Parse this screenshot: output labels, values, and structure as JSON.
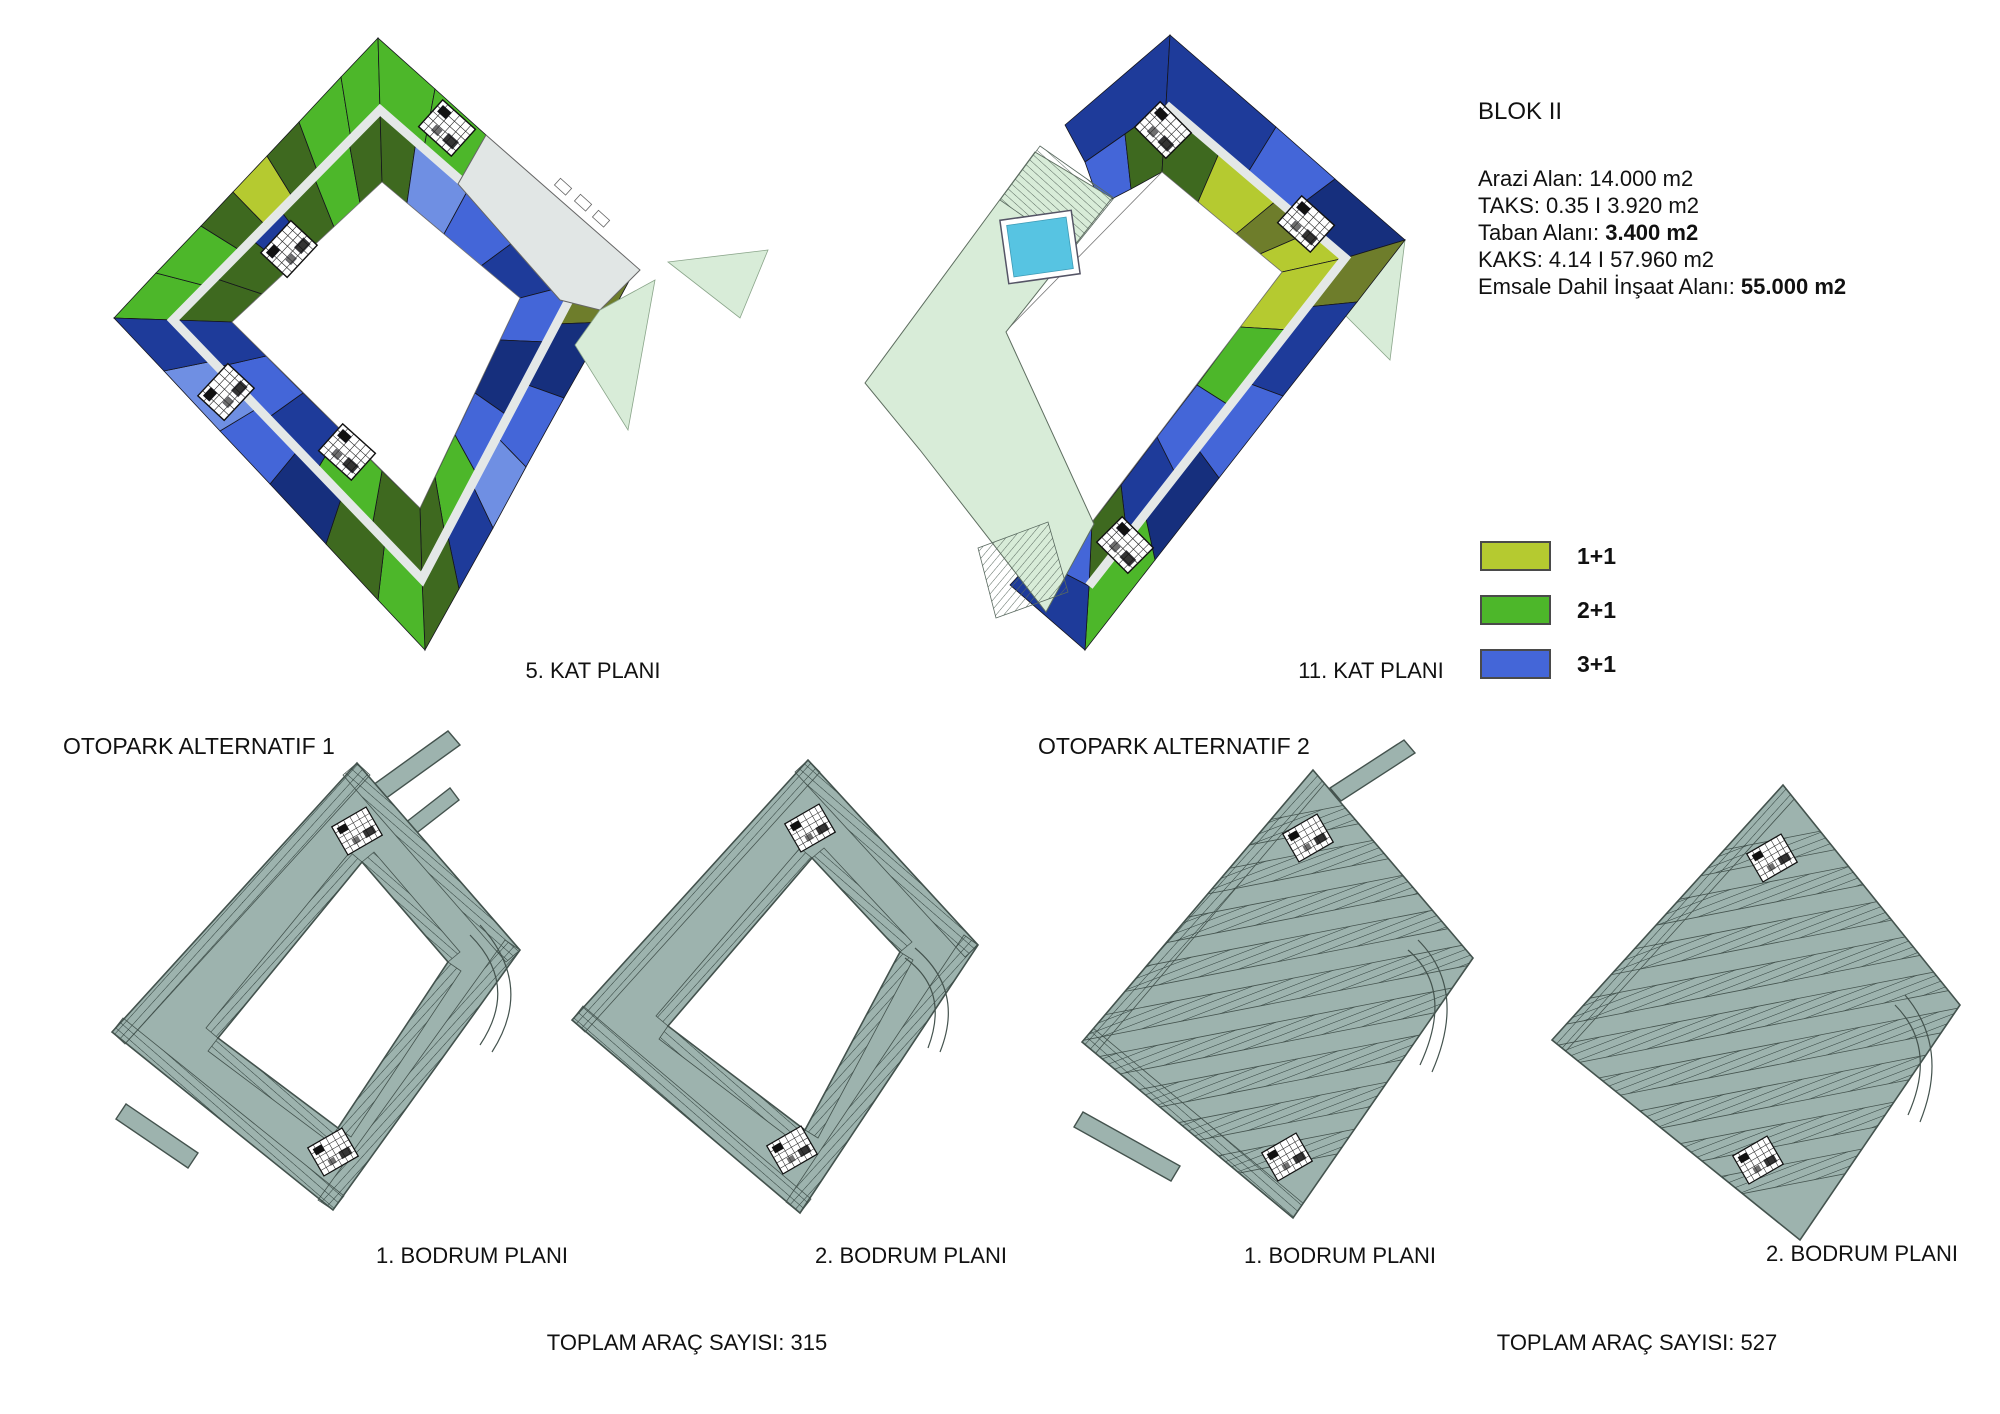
{
  "palette": {
    "green": "#4db72a",
    "darkGreen": "#3e691f",
    "yellowGreen": "#b5ca30",
    "khaki": "#6e7d2b",
    "blue": "#4466d8",
    "lightBlue": "#6f8fe3",
    "navy": "#1e3b9a",
    "navyDark": "#162f7d",
    "corridor": "#e4e8e7",
    "terraceGray": "#e1e6e5",
    "paleMint": "#d8ecd8",
    "pool": "#57c4e2",
    "parkSage": "#9db3ae",
    "parkLine": "#44534e",
    "stall": "#2e3e3a",
    "courtyard": "#ffffff"
  },
  "block_info": {
    "title": "BLOK II",
    "lines": [
      {
        "prefix": "Arazi Alan: 14.000 m2",
        "bold": ""
      },
      {
        "prefix": "TAKS: 0.35 I 3.920 m2",
        "bold": ""
      },
      {
        "prefix": "Taban Alanı: ",
        "bold": "3.400 m2"
      },
      {
        "prefix": "KAKS: 4.14 I 57.960 m2",
        "bold": ""
      },
      {
        "prefix": "Emsale Dahil İnşaat Alanı: ",
        "bold": "55.000 m2"
      }
    ]
  },
  "legend": {
    "items": [
      {
        "label": "1+1",
        "color": "yellowGreen"
      },
      {
        "label": "2+1",
        "color": "green"
      },
      {
        "label": "3+1",
        "color": "blue"
      }
    ]
  },
  "floor_plans": {
    "kat5": {
      "label": "5. KAT PLANI"
    },
    "kat11": {
      "label": "11. KAT PLANI"
    }
  },
  "otopark": {
    "alt1": {
      "title": "OTOPARK ALTERNATIF 1",
      "plans": [
        {
          "label": "1. BODRUM PLANI"
        },
        {
          "label": "2. BODRUM PLANI"
        }
      ],
      "total": "TOPLAM ARAÇ SAYISI: 315"
    },
    "alt2": {
      "title": "OTOPARK ALTERNATIF 2",
      "plans": [
        {
          "label": "1. BODRUM PLANI"
        },
        {
          "label": "2. BODRUM PLANI"
        }
      ],
      "total": "TOPLAM ARAÇ SAYISI: 527"
    }
  }
}
